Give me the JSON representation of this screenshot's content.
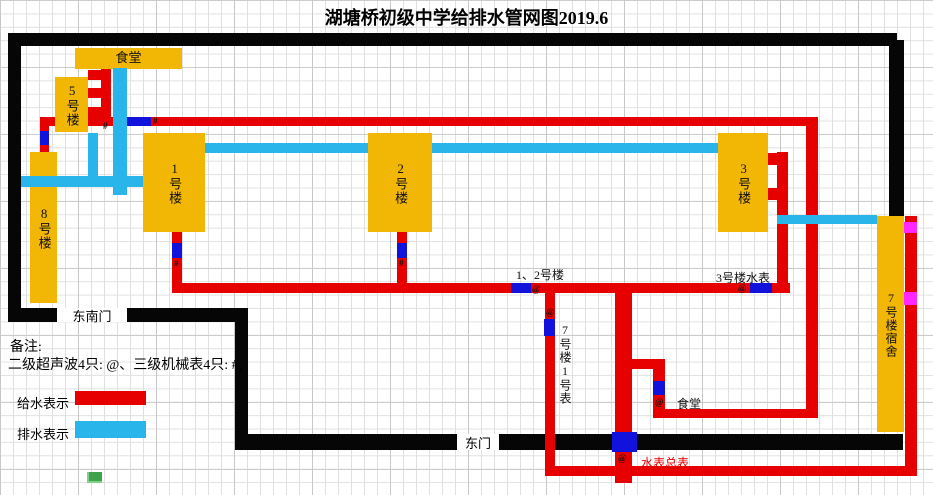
{
  "title": "湖塘桥初级中学给排水管网图2019.6",
  "legend": {
    "remark_title": "备注:",
    "remark_line": "二级超声波4只: @、三级机械表4只: #;",
    "supply_label": "给水表示",
    "drain_label": "排水表示"
  },
  "colors": {
    "supply_red": "#e60000",
    "drain_cyan": "#29b5ea",
    "meter_blue": "#1212dd",
    "building_yellow": "#f2b705",
    "boundary_black": "#060606",
    "marker_magenta": "#ff29ff",
    "main_meter_text_red": "#e60000"
  },
  "gates": {
    "southeast": "东南门",
    "east": "东门"
  },
  "buildings": [
    {
      "id": "canteen-top",
      "label": "食堂"
    },
    {
      "id": "building-5",
      "label": "5号楼"
    },
    {
      "id": "building-8",
      "label": "8号楼"
    },
    {
      "id": "building-1",
      "label": "1号楼"
    },
    {
      "id": "building-2",
      "label": "2号楼"
    },
    {
      "id": "building-3",
      "label": "3号楼"
    },
    {
      "id": "building-7-dorm",
      "label": "7号楼宿舍"
    }
  ],
  "annotations": {
    "meter_1_2": "1、2号楼",
    "meter_3": "3号楼水表",
    "meter_7_no1": "7号楼1号表",
    "meter_canteen": "食堂",
    "meter_main": "水表总表"
  },
  "symbols": {
    "ultrasonic": "@",
    "mechanical": "#"
  }
}
